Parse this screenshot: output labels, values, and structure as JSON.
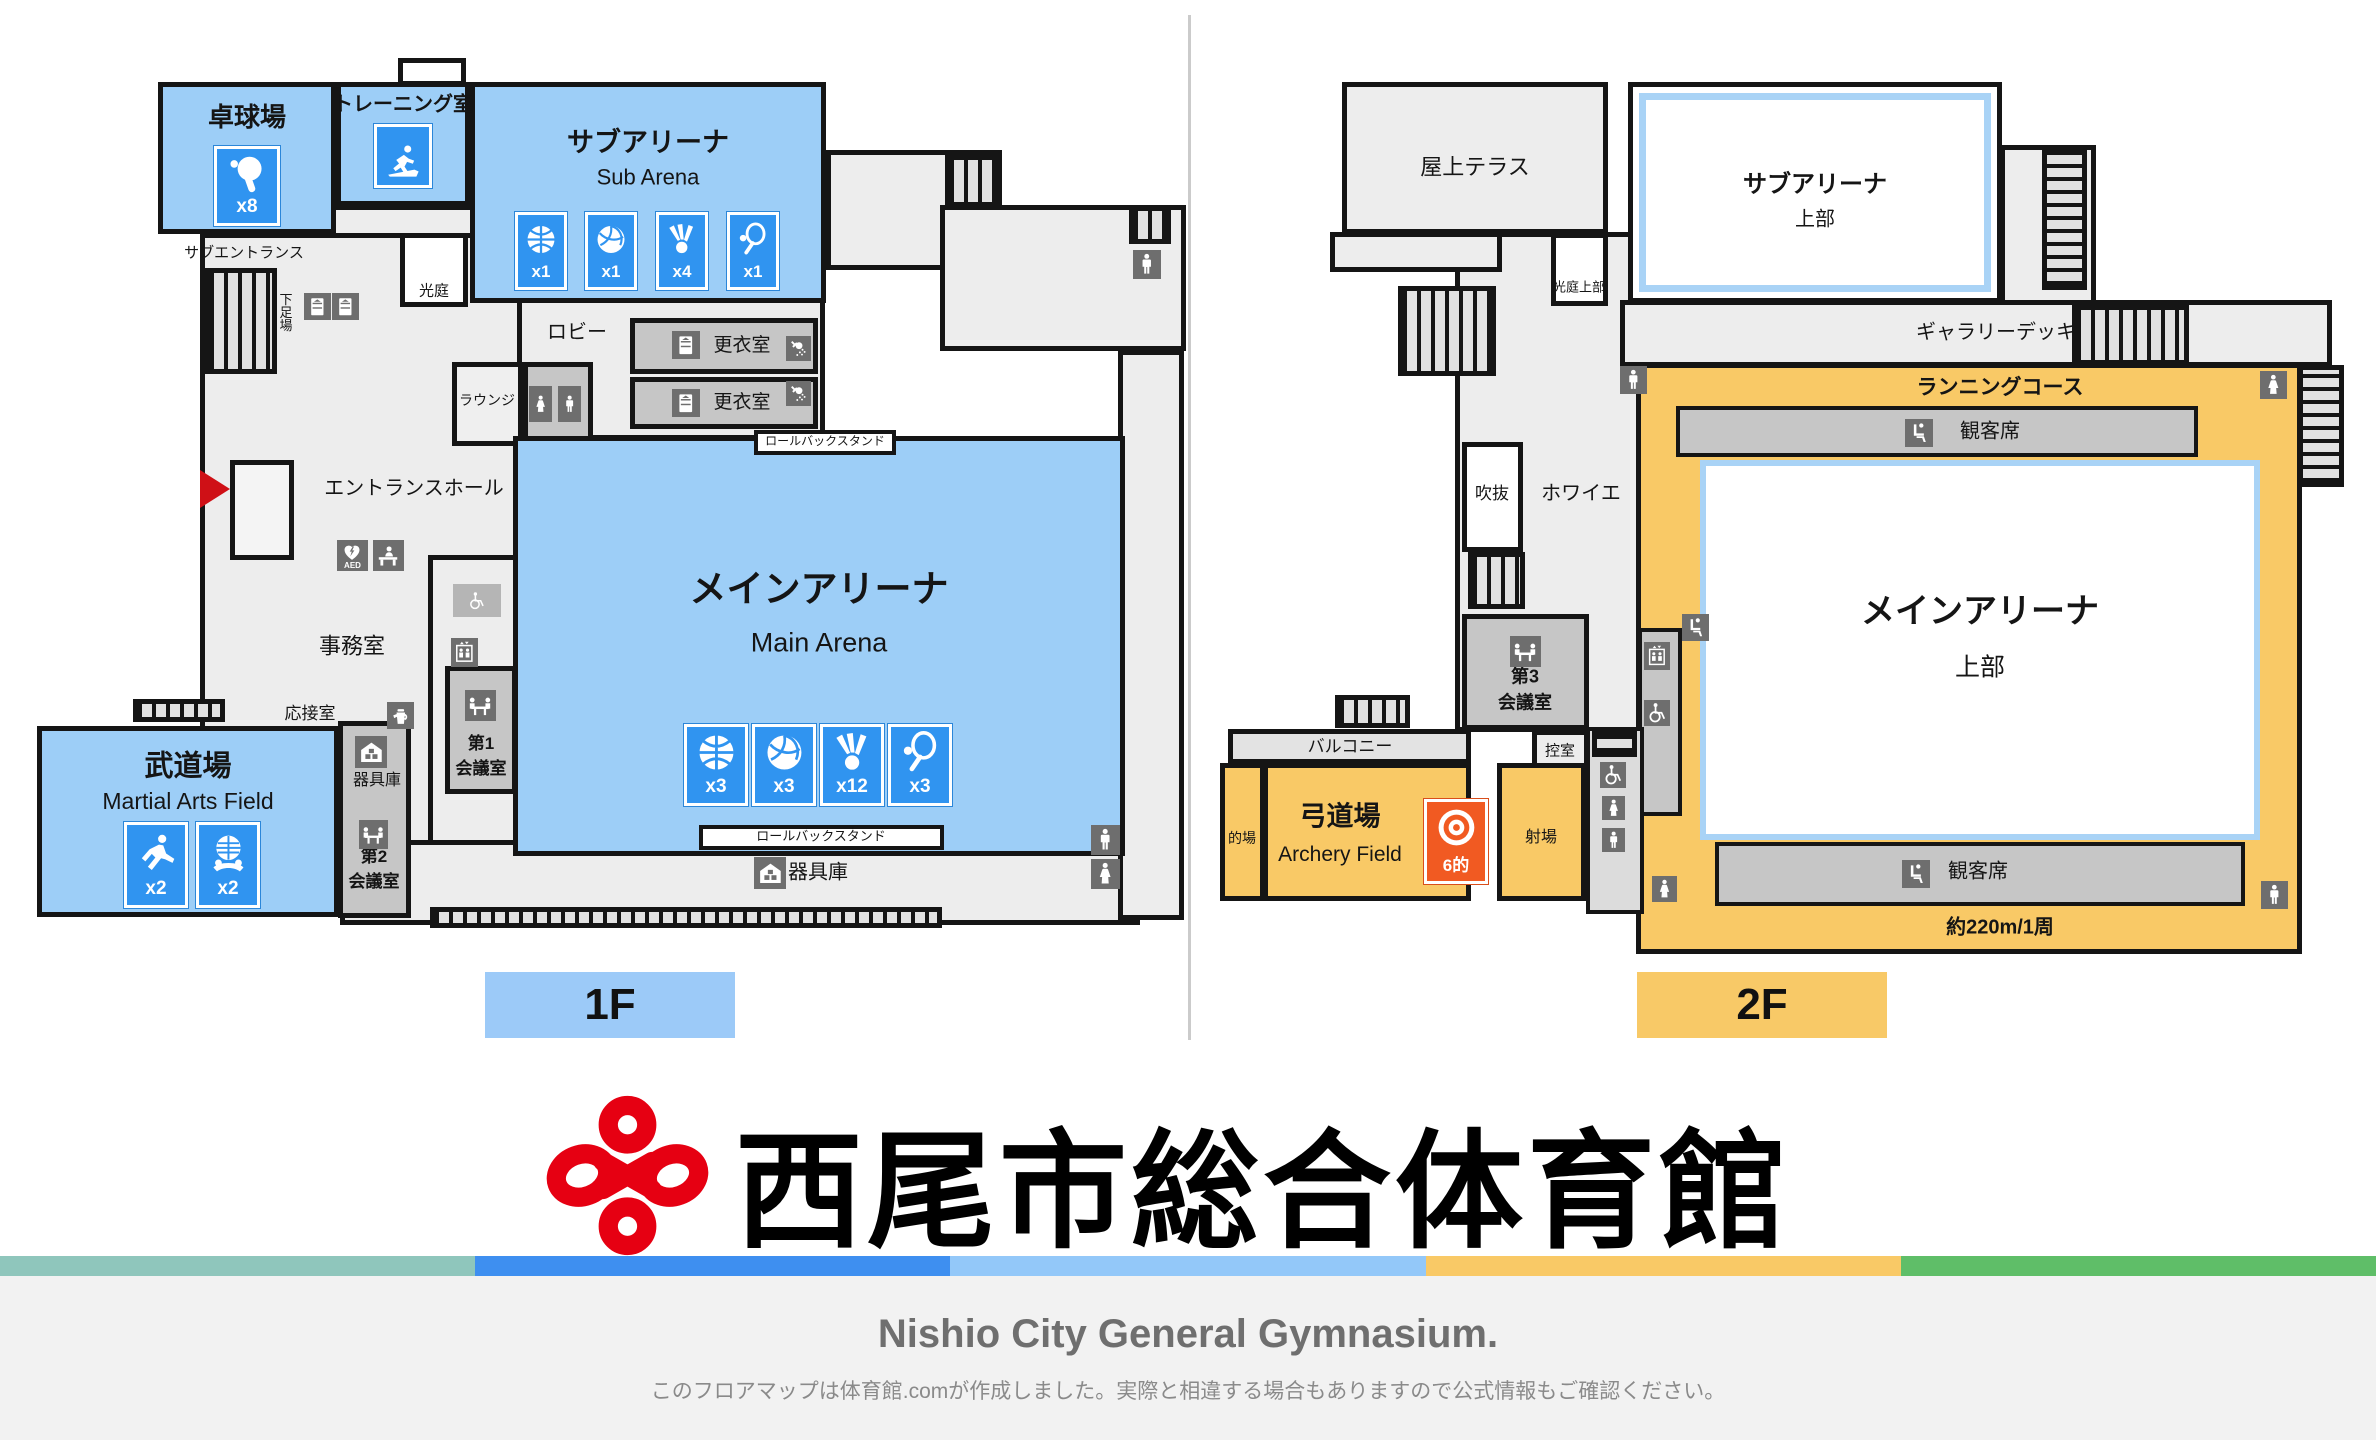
{
  "colors": {
    "room_blue": "#9DCEF7",
    "icon_blue": "#3094F0",
    "course_orange": "#F9C966",
    "target_orange": "#F15A22",
    "wall": "#151515",
    "mid_gray": "#C6C6C6",
    "badge_1f": "#9CCAF8",
    "badge_2f": "#F8C967",
    "logo_red": "#E60012",
    "footer_bg": "#F2F2F2"
  },
  "floor1": {
    "badge": "1F",
    "table_tennis": {
      "name": "卓球場",
      "count": "x8"
    },
    "training": {
      "name": "トレーニング室"
    },
    "sub_arena": {
      "name": "サブアリーナ",
      "en": "Sub Arena",
      "counts": {
        "basketball": "x1",
        "volleyball": "x1",
        "badminton": "x4",
        "tennis": "x1"
      }
    },
    "sub_entrance": "サブエントランス",
    "shoe_area": "下足場",
    "light_court": "光庭",
    "lobby": "ロビー",
    "locker_room_1": "更衣室",
    "locker_room_2": "更衣室",
    "lounge": "ラウンジ",
    "rollback_stand_top": "ロールバックスタンド",
    "entrance_hall": "エントランスホール",
    "main_arena": {
      "name": "メインアリーナ",
      "en": "Main Arena",
      "counts": {
        "basketball": "x3",
        "volleyball": "x3",
        "badminton": "x12",
        "tennis": "x3"
      }
    },
    "office": "事務室",
    "reception_room": "応接室",
    "aed": "AED",
    "equipment_room_upper": "器具庫",
    "meeting_room_1": {
      "line1": "第1",
      "line2": "会議室"
    },
    "martial_arts": {
      "name": "武道場",
      "en": "Martial Arts Field",
      "counts": {
        "karate": "x2",
        "kendo": "x2"
      }
    },
    "meeting_room_2": {
      "line1": "第2",
      "line2": "会議室"
    },
    "rollback_stand_bottom": "ロールバックスタンド",
    "equipment_room_bottom": "器具庫"
  },
  "floor2": {
    "badge": "2F",
    "roof_terrace": "屋上テラス",
    "sub_arena_upper": {
      "line1": "サブアリーナ",
      "line2": "上部"
    },
    "light_court_upper": "光庭上部",
    "gallery_deck": "ギャラリーデッキ",
    "running_course": "ランニングコース",
    "spectator_top": "観客席",
    "spectator_bottom": "観客席",
    "atrium": "吹抜",
    "foyer": "ホワイエ",
    "main_arena_upper": {
      "line1": "メインアリーナ",
      "line2": "上部"
    },
    "meeting_room_3": {
      "line1": "第3",
      "line2": "会議室"
    },
    "waiting_room": "控室",
    "balcony": "バルコニー",
    "archery": {
      "name": "弓道場",
      "en": "Archery Field",
      "target": "6的"
    },
    "target_area": "的場",
    "shooting_area": "射場",
    "lap_length": "約220m/1周"
  },
  "branding": {
    "title": "西尾市総合体育館"
  },
  "footer": {
    "en_title": "Nishio City General Gymnasium.",
    "note": "このフロアマップは体育館.comが作成しました。実際と相違する場合もありますので公式情報もご確認ください。",
    "stripe_colors": [
      "#8FC6BC",
      "#3E8FF0",
      "#93C8F9",
      "#F9C966",
      "#5FBE68"
    ]
  },
  "legend_icons": [
    "table-tennis",
    "treadmill-runner",
    "basketball",
    "volleyball",
    "badminton",
    "tennis",
    "karate",
    "kendo",
    "archery-target",
    "man-toilet",
    "woman-toilet",
    "wheelchair",
    "elevator",
    "meeting-table",
    "aed-heart",
    "reception-desk",
    "kettle",
    "storage-house",
    "locker",
    "shower",
    "spectator-seat",
    "stairs"
  ]
}
